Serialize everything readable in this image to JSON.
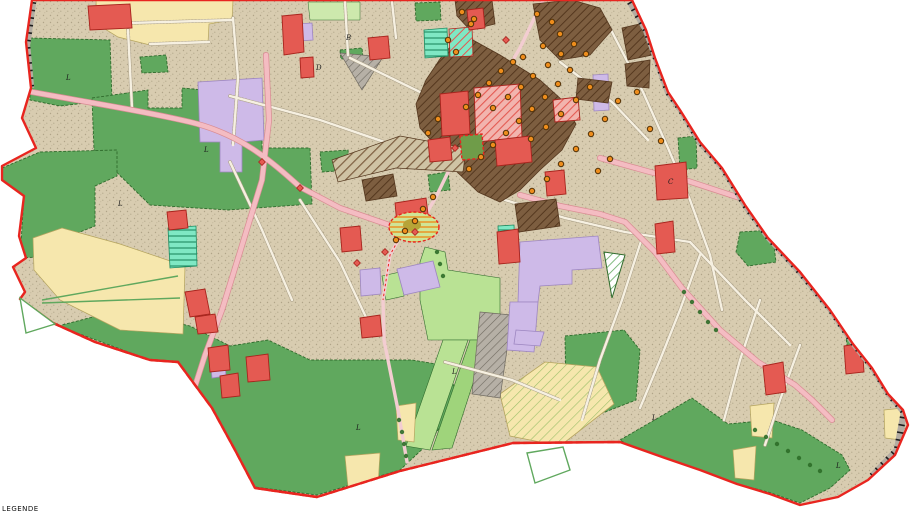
{
  "map": {
    "caption_partial": "LEGENDE",
    "zone_labels": [
      {
        "text": "L",
        "x": 66,
        "y": 80
      },
      {
        "text": "L",
        "x": 118,
        "y": 206
      },
      {
        "text": "L",
        "x": 204,
        "y": 152
      },
      {
        "text": "L",
        "x": 356,
        "y": 430
      },
      {
        "text": "L",
        "x": 452,
        "y": 374
      },
      {
        "text": "L",
        "x": 652,
        "y": 420
      },
      {
        "text": "L",
        "x": 836,
        "y": 468
      },
      {
        "text": "C",
        "x": 668,
        "y": 184
      },
      {
        "text": "D",
        "x": 316,
        "y": 70
      },
      {
        "text": "B",
        "x": 346,
        "y": 40
      }
    ],
    "poi_dots_orange": [
      [
        462,
        12
      ],
      [
        471,
        24
      ],
      [
        448,
        40
      ],
      [
        456,
        52
      ],
      [
        474,
        19
      ],
      [
        537,
        14
      ],
      [
        552,
        22
      ],
      [
        560,
        34
      ],
      [
        543,
        46
      ],
      [
        523,
        57
      ],
      [
        513,
        62
      ],
      [
        501,
        71
      ],
      [
        489,
        83
      ],
      [
        478,
        95
      ],
      [
        466,
        107
      ],
      [
        493,
        108
      ],
      [
        508,
        97
      ],
      [
        521,
        87
      ],
      [
        533,
        76
      ],
      [
        548,
        65
      ],
      [
        561,
        54
      ],
      [
        574,
        44
      ],
      [
        586,
        54
      ],
      [
        570,
        70
      ],
      [
        558,
        84
      ],
      [
        545,
        97
      ],
      [
        532,
        109
      ],
      [
        519,
        121
      ],
      [
        506,
        133
      ],
      [
        493,
        145
      ],
      [
        481,
        157
      ],
      [
        469,
        169
      ],
      [
        531,
        139
      ],
      [
        546,
        127
      ],
      [
        561,
        114
      ],
      [
        576,
        100
      ],
      [
        590,
        87
      ],
      [
        605,
        119
      ],
      [
        591,
        134
      ],
      [
        576,
        149
      ],
      [
        561,
        164
      ],
      [
        547,
        179
      ],
      [
        532,
        191
      ],
      [
        438,
        119
      ],
      [
        428,
        133
      ],
      [
        423,
        209
      ],
      [
        433,
        197
      ],
      [
        415,
        221
      ],
      [
        405,
        231
      ],
      [
        396,
        240
      ],
      [
        618,
        101
      ],
      [
        637,
        92
      ],
      [
        650,
        129
      ],
      [
        661,
        141
      ],
      [
        610,
        159
      ],
      [
        598,
        171
      ]
    ],
    "poi_diamonds_red": [
      [
        455,
        148
      ],
      [
        506,
        40
      ],
      [
        415,
        232
      ],
      [
        385,
        252
      ],
      [
        300,
        188
      ],
      [
        262,
        162
      ],
      [
        357,
        263
      ]
    ],
    "trees": [
      [
        3,
        84
      ],
      [
        10,
        86
      ],
      [
        17,
        88
      ],
      [
        24,
        91
      ],
      [
        755,
        430
      ],
      [
        766,
        437
      ],
      [
        777,
        444
      ],
      [
        788,
        451
      ],
      [
        799,
        458
      ],
      [
        810,
        465
      ],
      [
        820,
        471
      ],
      [
        399,
        420
      ],
      [
        402,
        432
      ],
      [
        404,
        444
      ],
      [
        406,
        456
      ],
      [
        437,
        252
      ],
      [
        440,
        264
      ],
      [
        443,
        276
      ],
      [
        684,
        292
      ],
      [
        692,
        302
      ],
      [
        700,
        312
      ],
      [
        708,
        322
      ],
      [
        716,
        330
      ]
    ],
    "palette": {
      "outside": "#ffffff",
      "tan": "#d8ccb0",
      "stipple": "#8f8468",
      "boundary": "#e8251f",
      "road": "#f4bcc2",
      "road_edge": "#d98b92",
      "road_pale": "#f3cdd1",
      "street": "#f6f0e1",
      "street_edge": "#aba088",
      "green": "#60a85e",
      "green_dk": "#2f6b2c",
      "lgreen": "#b9e294",
      "lgreen2": "#9fd47b",
      "palegreen": "#cde9ad",
      "cream": "#f6e7ad",
      "cream_dk": "#b5a45e",
      "purple": "#cebae8",
      "purple_dk": "#9d86c0",
      "brown": "#7d5e40",
      "brown_dk": "#55381f",
      "red": "#e45a52",
      "red_dk": "#a8241d",
      "teal": "#7fe8c4",
      "teal_dk": "#1f8a60",
      "gray": "#b6b0a6",
      "gray_dk": "#6f6a60",
      "rail": "#b3aca2",
      "orange": "#ee8d1c",
      "orange_dk": "#513209",
      "label": "#1c1c1c",
      "tree": "#2e6d28",
      "olive": "#b7a437",
      "poi_green": "#6f9c49",
      "poi_lgreen": "#cfe596"
    }
  }
}
